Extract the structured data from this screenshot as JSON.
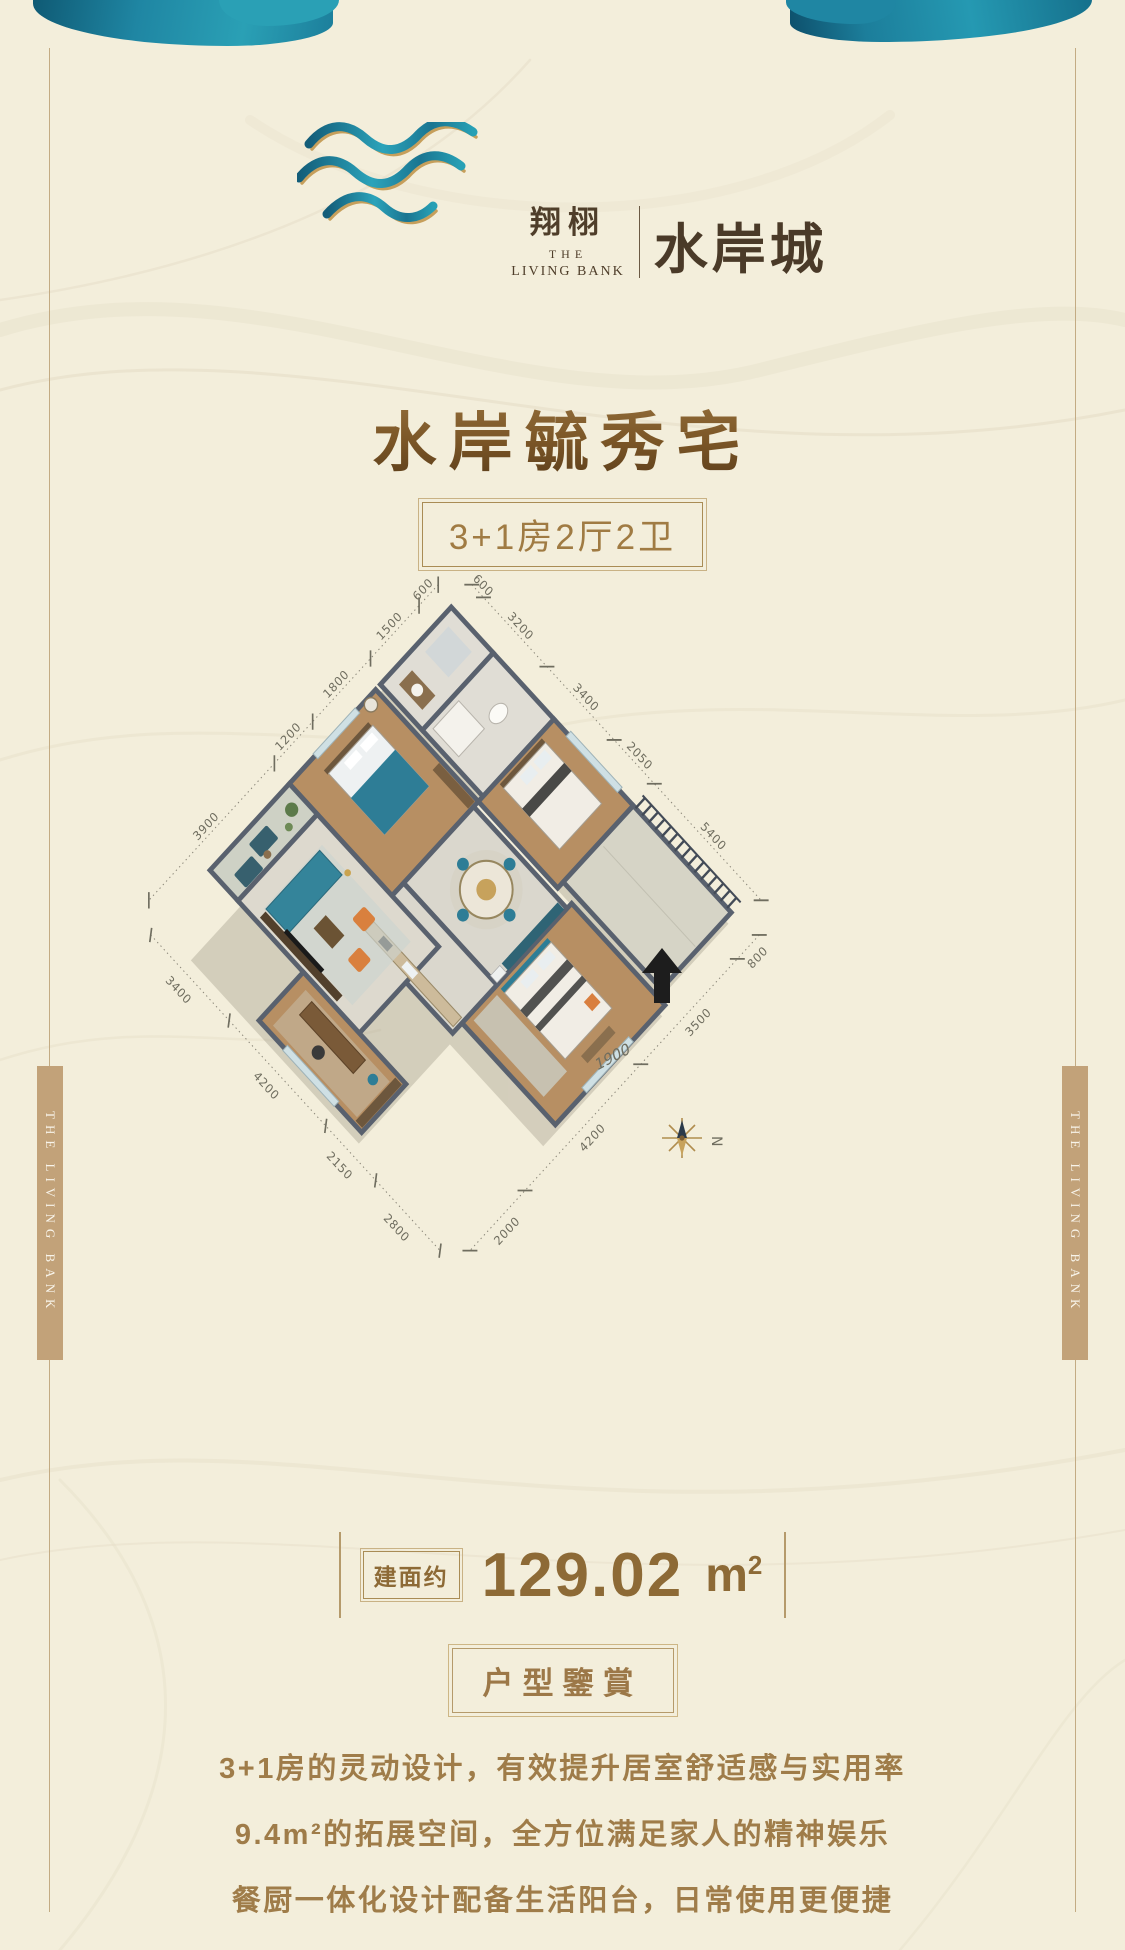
{
  "logo": {
    "brand_cn": "翔栩",
    "brand_en_line1": "THE",
    "brand_en_line2": "LIVING BANK",
    "project_name": "水岸城"
  },
  "hero": {
    "title": "水岸毓秀宅",
    "badge": "3+1房2厅2卫"
  },
  "floorplan": {
    "compass_label": "N",
    "inner_dim": "1900",
    "nw_chain": [
      "600",
      "1500",
      "1800",
      "1200",
      "3900"
    ],
    "ne_chain": [
      "600",
      "3200",
      "3400",
      "2050",
      "5400"
    ],
    "se_chain": [
      "800",
      "3500",
      "4200",
      "2000"
    ],
    "sw_chain": [
      "3400",
      "4200",
      "2150",
      "2800"
    ]
  },
  "area": {
    "label": "建面约",
    "value": "129.02",
    "unit_base": "m",
    "unit_sup": "2"
  },
  "section": {
    "badge": "户型鑒賞"
  },
  "description": {
    "lines": [
      "3+1房的灵动设计，有效提升居室舒适感与实用率",
      "9.4m²的拓展空间，全方位满足家人的精神娱乐",
      "餐厨一体化设计配备生活阳台，日常使用更便捷"
    ]
  },
  "side_tag": {
    "text": "THE LIVING BANK"
  },
  "colors": {
    "background": "#f3eedb",
    "teal": "#1f86a3",
    "gold": "#c49b55",
    "brown_text": "#9c7848",
    "tag_tan": "#c2a279"
  }
}
